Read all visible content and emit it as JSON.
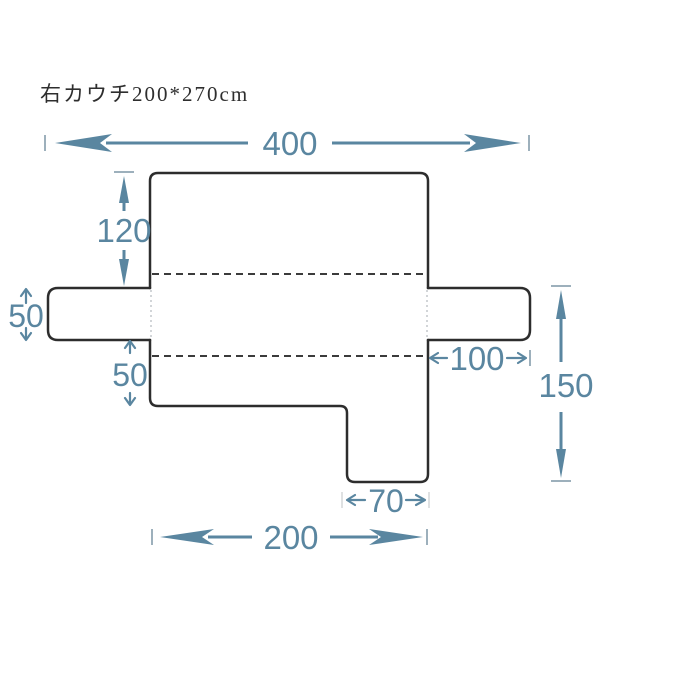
{
  "title": "右カウチ200*270cm",
  "diagram": {
    "name": "couch-cover-dimension-diagram",
    "unit": "cm",
    "labels": {
      "total_width": "400",
      "back_height": "120",
      "left_arm_drop": "50",
      "front_seat_drop": "50",
      "right_arm_width": "100",
      "right_side_height": "150",
      "chaise_width": "70",
      "seat_width": "200"
    },
    "colors": {
      "dimension": "#5a86a0",
      "outline": "#2d2d2d",
      "fold_dash": "#3b3b3b",
      "tick": "#9db0bc",
      "junction_dotted": "#c3c7cb",
      "title_text": "#2e2e2e",
      "background": "#ffffff"
    }
  }
}
